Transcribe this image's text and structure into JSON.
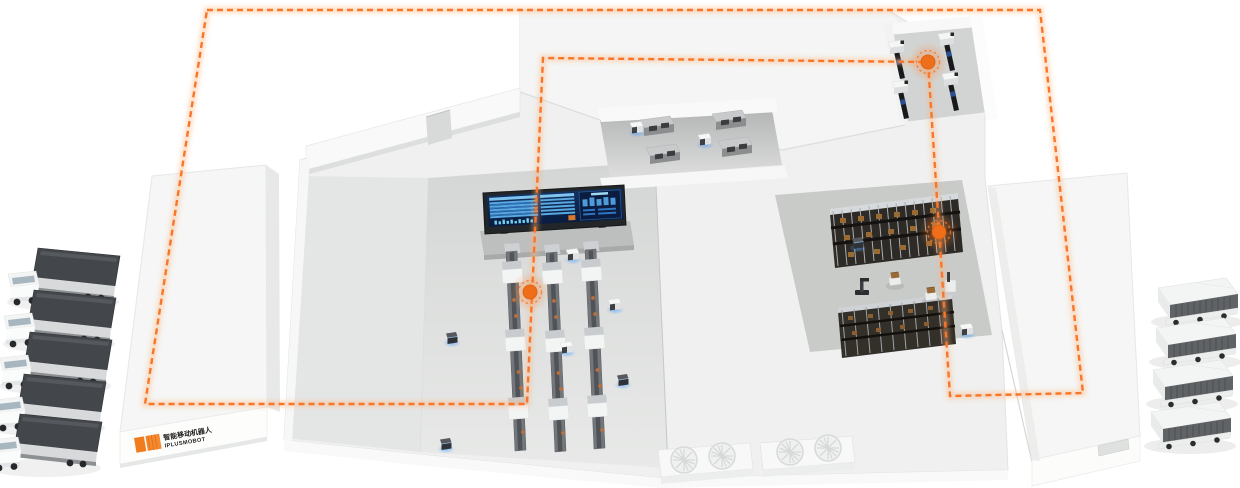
{
  "meta": {
    "title": "Smart factory AGV logistics isometric illustration",
    "style": "isometric 3D factory map with orange dashed AGV route loop"
  },
  "colors": {
    "bg": "#ffffff",
    "route": "#f8762a",
    "route-glow": "#ffb37a",
    "node": "#ef6e1a",
    "agv-glow": "#58a6ff",
    "logo-accent": "#f07c1e",
    "logo-text": "#1e1c1a",
    "screen-bg": "#0d2248",
    "screen-row": "#5fb3e6",
    "screen-row-alt": "#2f74c0",
    "screen-panel": "#0a1c3f",
    "screen-accent": "#d9782e",
    "building-top": "#f3f4f3",
    "building-front": "#fbfcfb",
    "floor": "#e9ebea",
    "floor-dark": "#cfd1d0",
    "rack-dark": "#2e2a25",
    "conveyor": "#6e7174",
    "trailer": "#43464a",
    "van-side": "#606366"
  },
  "logo": {
    "text_cn": "智能移动机器人",
    "text_en": "IPLUSMOBOT"
  },
  "route": {
    "style": "dashed-loop",
    "points": [
      [
        207,
        10
      ],
      [
        1040,
        10
      ],
      [
        1083,
        393
      ],
      [
        950,
        396
      ],
      [
        928,
        62
      ],
      [
        543,
        58
      ],
      [
        527,
        404
      ],
      [
        145,
        404
      ]
    ],
    "nodes": [
      [
        928,
        62
      ],
      [
        939,
        232
      ],
      [
        530,
        292
      ]
    ]
  },
  "objects": {
    "left_trucks": {
      "label": "cargo trucks (outbound dock)",
      "count": 5
    },
    "right_vans": {
      "label": "container vans (inbound dock)",
      "count": 4
    },
    "production_lines": {
      "label": "production conveyor lines",
      "count": 3
    },
    "workstations": {
      "label": "workstations",
      "count": 4
    },
    "pick_machines": {
      "label": "pick conveyor machines",
      "count": 4
    },
    "storage_racks": {
      "label": "storage racks",
      "count": 2
    },
    "dock_fans": {
      "label": "dock turntables",
      "count": 4
    },
    "agvs": {
      "label": "AGV mobile robots",
      "count": 13
    },
    "dashboard": {
      "label": "central monitoring screen",
      "count": 1
    }
  }
}
